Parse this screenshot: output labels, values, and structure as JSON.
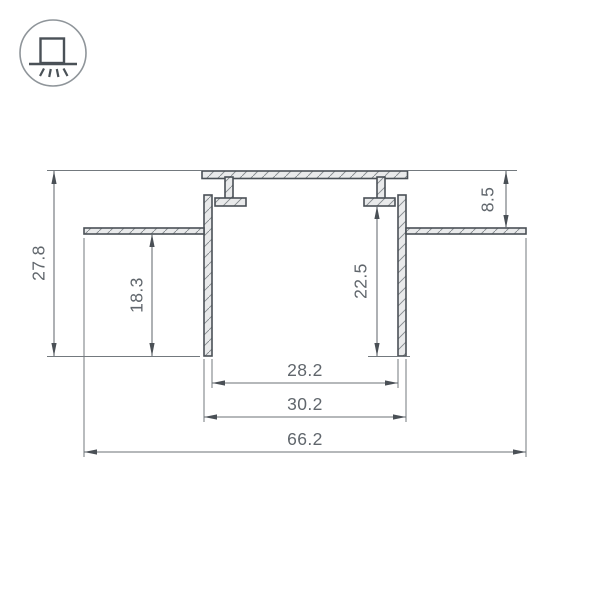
{
  "icon": {
    "name": "recessed-downlight-mount",
    "meaning": "profile mounted flush in ceiling, light emitted downward"
  },
  "drawing": {
    "kind": "aluminium-led-profile-cross-section",
    "dimensions": {
      "overall_height": "27.8",
      "left_inner_depth": "18.3",
      "recess_offset": "8.5",
      "right_inner_depth": "22.5",
      "inner_width": "28.2",
      "body_width": "30.2",
      "overall_width": "66.2"
    }
  },
  "colors": {
    "background": "#ffffff",
    "profile_outline": "#4a5056",
    "section_fill": "#e9eaeb",
    "hatch_lines": "#81878b",
    "dimension_lines": "#6b7176",
    "dimension_text": "#60666c",
    "icon_symbol": "#4a5157",
    "icon_circle": "#8f959a"
  }
}
